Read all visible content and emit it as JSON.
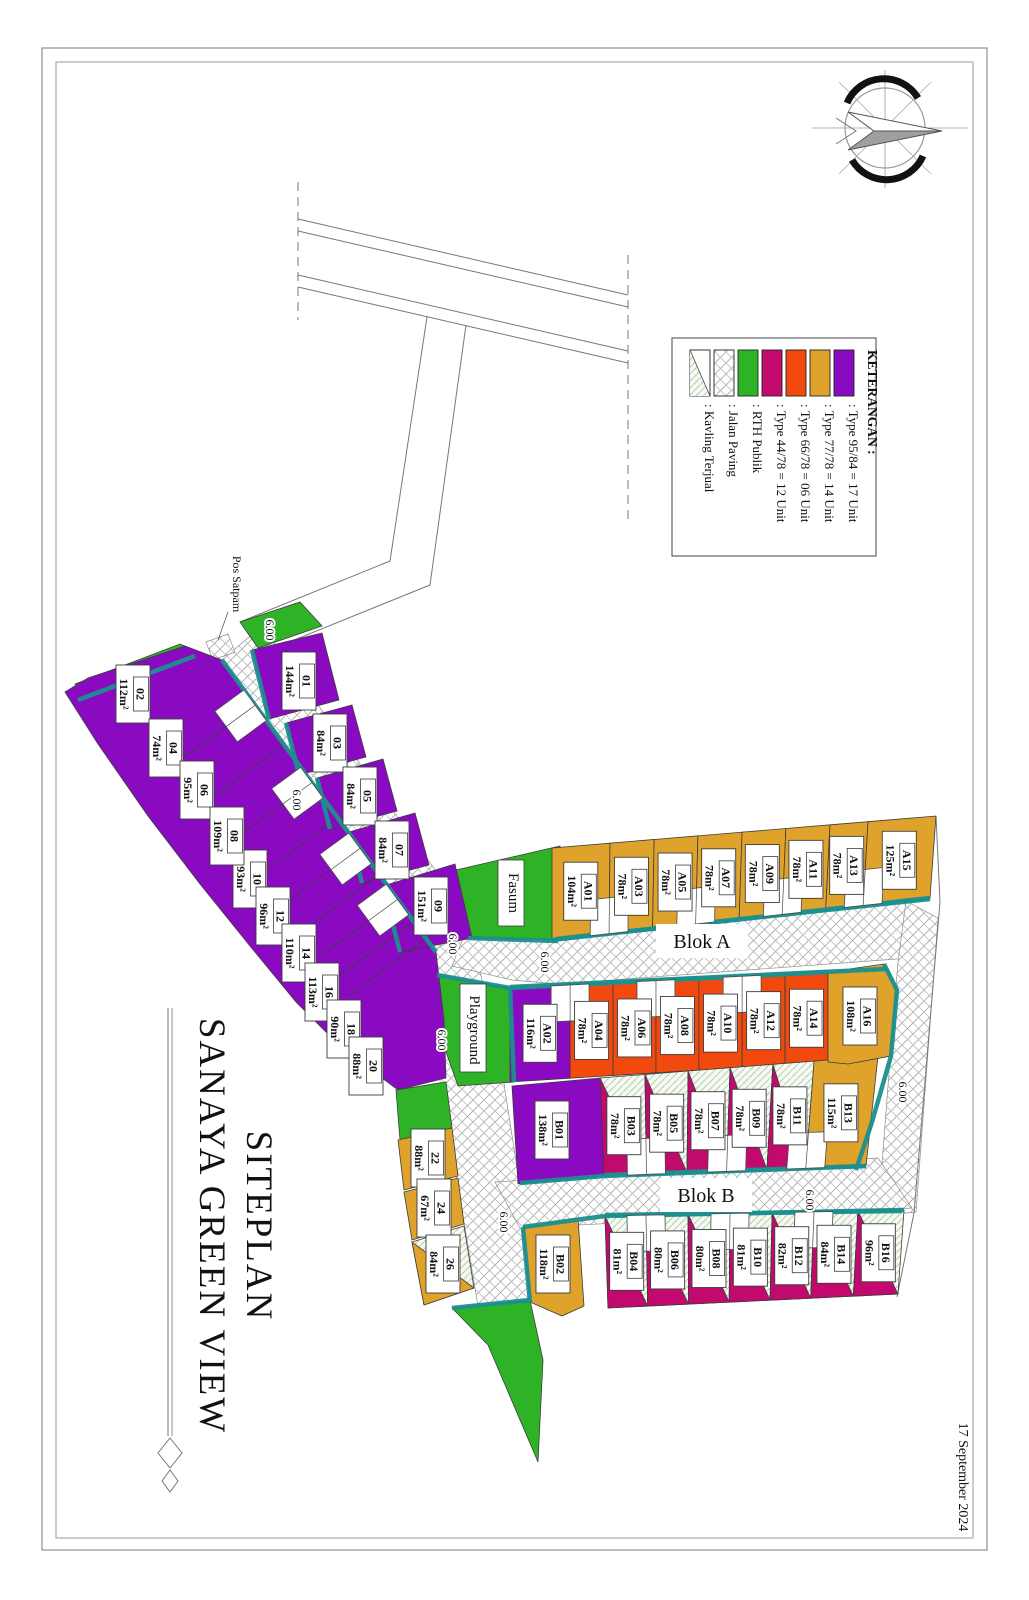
{
  "title": {
    "line1": "SITEPLAN",
    "line2": "SANAYA GREEN VIEW"
  },
  "date": "17 September 2024",
  "legend": {
    "heading": "KETERANGAN :",
    "items": [
      {
        "key": "t95",
        "label": ": Type 95/84   =   17 Unit",
        "color": "#8A0AC2"
      },
      {
        "key": "t77",
        "label": ": Type 77/78   =   14 Unit",
        "color": "#DFA32B"
      },
      {
        "key": "t66",
        "label": ": Type 66/78   =   06 Unit",
        "color": "#F24A0E"
      },
      {
        "key": "t44",
        "label": ": Type 44/78   =   12 Unit",
        "color": "#C2096E"
      },
      {
        "key": "rth",
        "label": ": RTH Publik",
        "color": "#2EB327"
      },
      {
        "key": "paving",
        "label": ": Jalan Paving",
        "color": "pattern-paving"
      },
      {
        "key": "terjual",
        "label": ": Kavling Terjual",
        "color": "pattern-sold"
      }
    ]
  },
  "colors": {
    "t95": "#8A0AC2",
    "t77": "#DFA32B",
    "t66": "#F24A0E",
    "t44": "#C2096E",
    "rth": "#2EB327",
    "teal": "#1C8F8F"
  },
  "road_labels": {
    "blok_a": "Blok A",
    "blok_b": "Blok B",
    "width": "6.00",
    "pos_satpam": "Pos Satpam"
  },
  "areas": {
    "fasum": "Fasum",
    "playground": "Playground"
  },
  "lots": [
    {
      "id": "01",
      "area": "144m²",
      "type": "t95",
      "sold": false
    },
    {
      "id": "02",
      "area": "112m²",
      "type": "t95",
      "sold": false
    },
    {
      "id": "03",
      "area": "84m²",
      "type": "t95",
      "sold": false
    },
    {
      "id": "04",
      "area": "74m²",
      "type": "t95",
      "sold": false
    },
    {
      "id": "05",
      "area": "84m²",
      "type": "t95",
      "sold": false
    },
    {
      "id": "06",
      "area": "95m²",
      "type": "t95",
      "sold": false
    },
    {
      "id": "07",
      "area": "84m²",
      "type": "t95",
      "sold": false
    },
    {
      "id": "08",
      "area": "109m²",
      "type": "t95",
      "sold": false
    },
    {
      "id": "09",
      "area": "151m²",
      "type": "t95",
      "sold": false
    },
    {
      "id": "10",
      "area": "93m²",
      "type": "t95",
      "sold": false
    },
    {
      "id": "12",
      "area": "96m²",
      "type": "t95",
      "sold": false
    },
    {
      "id": "14",
      "area": "110m²",
      "type": "t95",
      "sold": false
    },
    {
      "id": "16",
      "area": "113m²",
      "type": "t95",
      "sold": false
    },
    {
      "id": "18",
      "area": "90m²",
      "type": "t95",
      "sold": false
    },
    {
      "id": "20",
      "area": "88m²",
      "type": "t95",
      "sold": false
    },
    {
      "id": "22",
      "area": "88m²",
      "type": "t77",
      "sold": false
    },
    {
      "id": "24",
      "area": "67m²",
      "type": "t77",
      "sold": false
    },
    {
      "id": "26",
      "area": "84m²",
      "type": "t77",
      "sold": true
    },
    {
      "id": "A01",
      "area": "104m²",
      "type": "t77",
      "sold": false
    },
    {
      "id": "A02",
      "area": "116m²",
      "type": "t95",
      "sold": false
    },
    {
      "id": "A03",
      "area": "78m²",
      "type": "t77",
      "sold": false
    },
    {
      "id": "A04",
      "area": "78m²",
      "type": "t66",
      "sold": false
    },
    {
      "id": "A05",
      "area": "78m²",
      "type": "t77",
      "sold": false
    },
    {
      "id": "A06",
      "area": "78m²",
      "type": "t66",
      "sold": false
    },
    {
      "id": "A07",
      "area": "78m²",
      "type": "t77",
      "sold": false
    },
    {
      "id": "A08",
      "area": "78m²",
      "type": "t66",
      "sold": false
    },
    {
      "id": "A09",
      "area": "78m²",
      "type": "t77",
      "sold": false
    },
    {
      "id": "A10",
      "area": "78m²",
      "type": "t66",
      "sold": false
    },
    {
      "id": "A11",
      "area": "78m²",
      "type": "t77",
      "sold": false
    },
    {
      "id": "A12",
      "area": "78m²",
      "type": "t66",
      "sold": false
    },
    {
      "id": "A13",
      "area": "78m²",
      "type": "t77",
      "sold": false
    },
    {
      "id": "A14",
      "area": "78m²",
      "type": "t66",
      "sold": false
    },
    {
      "id": "A15",
      "area": "125m²",
      "type": "t77",
      "sold": false
    },
    {
      "id": "A16",
      "area": "108m²",
      "type": "t77",
      "sold": false
    },
    {
      "id": "B01",
      "area": "138m²",
      "type": "t95",
      "sold": false
    },
    {
      "id": "B02",
      "area": "118m²",
      "type": "t77",
      "sold": false
    },
    {
      "id": "B03",
      "area": "78m²",
      "type": "t44",
      "sold": true
    },
    {
      "id": "B04",
      "area": "81m²",
      "type": "t44",
      "sold": true
    },
    {
      "id": "B05",
      "area": "78m²",
      "type": "t44",
      "sold": true
    },
    {
      "id": "B06",
      "area": "80m²",
      "type": "t44",
      "sold": true
    },
    {
      "id": "B07",
      "area": "78m²",
      "type": "t44",
      "sold": true
    },
    {
      "id": "B08",
      "area": "80m²",
      "type": "t44",
      "sold": true
    },
    {
      "id": "B09",
      "area": "78m²",
      "type": "t44",
      "sold": true
    },
    {
      "id": "B10",
      "area": "81m²",
      "type": "t44",
      "sold": true
    },
    {
      "id": "B11",
      "area": "78m²",
      "type": "t44",
      "sold": true
    },
    {
      "id": "B12",
      "area": "82m²",
      "type": "t44",
      "sold": true
    },
    {
      "id": "B13",
      "area": "115m²",
      "type": "t77",
      "sold": false
    },
    {
      "id": "B14",
      "area": "84m²",
      "type": "t44",
      "sold": true
    },
    {
      "id": "B16",
      "area": "96m²",
      "type": "t44",
      "sold": true
    }
  ]
}
